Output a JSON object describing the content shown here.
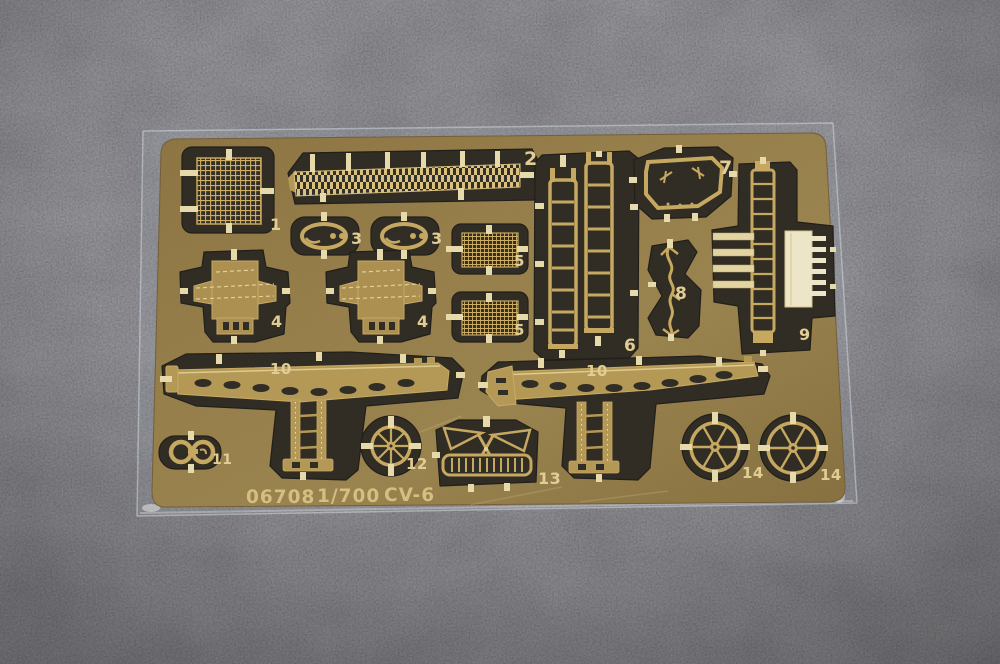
{
  "photo": {
    "subject": "photo-etched brass model detail fret in clear sleeve on gray carpet",
    "footer": {
      "code": "06708",
      "scale": "1/700",
      "ship": "CV-6"
    },
    "part_labels": [
      "1",
      "2",
      "3",
      "3",
      "4",
      "4",
      "5",
      "5",
      "6",
      "7",
      "8",
      "9",
      "10",
      "10",
      "11",
      "12",
      "13",
      "14",
      "14"
    ],
    "colors": {
      "carpet": "#3a3a3e",
      "brass": "#8d733e",
      "etch_gold": "#c7a75a",
      "bright_tab": "#eaddaa",
      "bright_part": "#f2e9c9",
      "cutout": "#262219",
      "label_gold": "#e4cf92",
      "footer_gold": "#d8bf7d",
      "sleeve": "#d8dfe9"
    }
  }
}
